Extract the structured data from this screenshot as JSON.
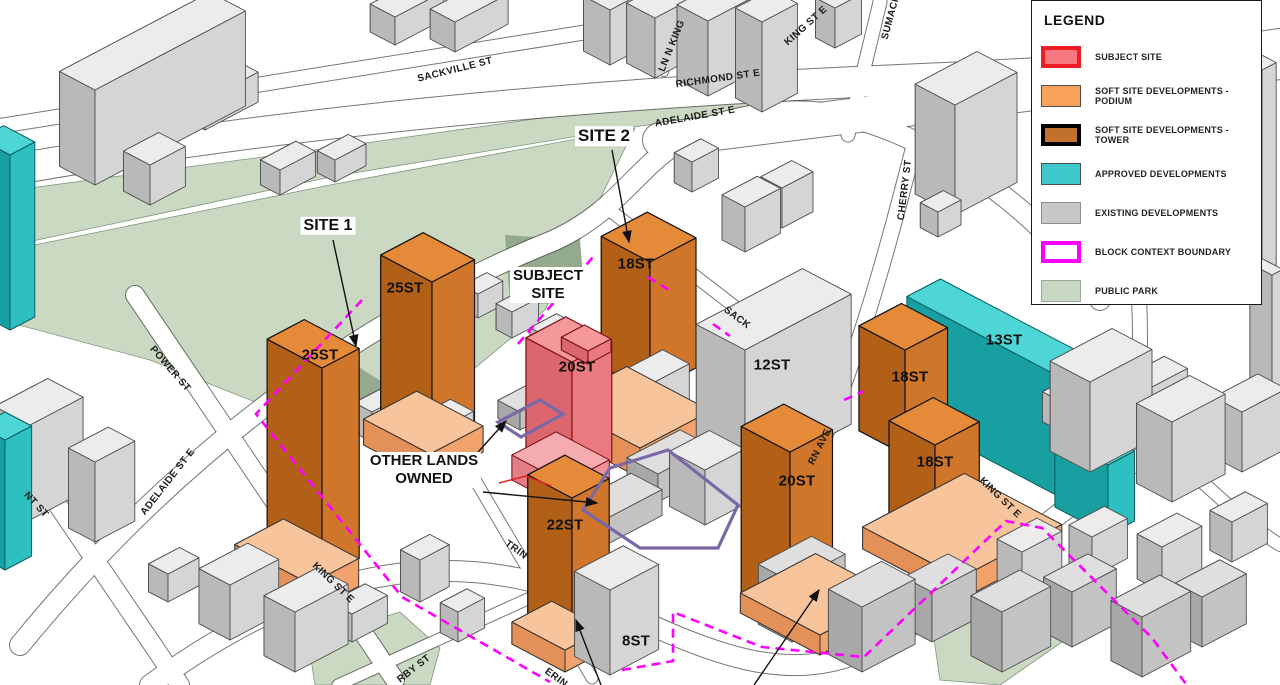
{
  "legend": {
    "title": "LEGEND",
    "items": [
      {
        "label": "SUBJECT SITE",
        "fill": "#F4787E",
        "border": "#EE1C25",
        "border_px": 4
      },
      {
        "label": "SOFT SITE DEVELOPMENTS - PODIUM",
        "fill": "#F9A35B",
        "border": "#4d4d4d",
        "border_px": 1
      },
      {
        "label": "SOFT SITE DEVELOPMENTS - TOWER",
        "fill": "#C2702D",
        "border": "#000000",
        "border_px": 4
      },
      {
        "label": "APPROVED DEVELOPMENTS",
        "fill": "#3FC8CB",
        "border": "#4d4d4d",
        "border_px": 1
      },
      {
        "label": "EXISTING DEVELOPMENTS",
        "fill": "#C8C8C8",
        "border": "#8c8c8c",
        "border_px": 1
      },
      {
        "label": "BLOCK CONTEXT BOUNDARY",
        "fill": "#FFFFFF",
        "border": "#FB00FB",
        "border_px": 4
      },
      {
        "label": "PUBLIC PARK",
        "fill": "#C9D8C2",
        "border": "#9aa99a",
        "border_px": 1
      }
    ]
  },
  "annotations": {
    "site1": "SITE 1",
    "site2": "SITE 2",
    "subject_line1": "SUBJECT",
    "subject_line2": "SITE",
    "other_lands_line1": "OTHER LANDS",
    "other_lands_line2": "OWNED"
  },
  "buildings": {
    "site1_tower_a": "25ST",
    "site1_tower_b": "25ST",
    "site2_tower": "18ST",
    "subject_tower": "20ST",
    "king_tower": "22ST",
    "south_tower": "20ST",
    "east_tower_a": "18ST",
    "east_tower_b": "18ST",
    "existing_12st": "12ST",
    "approved_13st": "13ST",
    "existing_8st": "8ST"
  },
  "streets": {
    "sackville": "SACKVILLE ST",
    "richmond": "RICHMOND ST E",
    "adelaide_top": "ADELAIDE ST E",
    "adelaide_left": "ADELAIDE ST E",
    "king_left": "KING ST E",
    "king_right": "KING ST E",
    "king_top": "KING ST E",
    "ln_n_king": "LN N KING",
    "sumach": "SUMACH",
    "cherry": "CHERRY ST",
    "power": "POWER ST",
    "nt_st_partial": "NT ST",
    "sack_partial": "SACK",
    "rn_ave_partial": "RN AVE",
    "trin_partial": "TRIN",
    "erin_partial": "ERIN",
    "rby_st_partial": "RBY ST"
  },
  "colors": {
    "block_context_boundary": "#FF00FF",
    "other_lands_outline": "#7A68A6",
    "park_shadow": "#93AA8F",
    "road_edge": "#3d3d3d"
  }
}
